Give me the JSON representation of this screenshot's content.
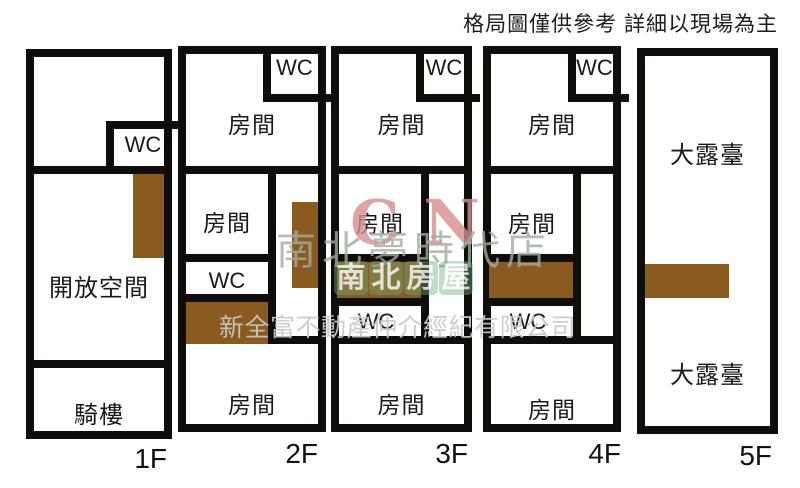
{
  "disclaimer": "格局圖僅供參考 詳細以現場為主",
  "watermark": {
    "initials": "CN",
    "store_line": "南北夢時代店",
    "brand_line": "南北房屋",
    "company_line": "新全富不動產仲介經紀有限公司"
  },
  "colors": {
    "wall": "#0f0d0a",
    "stair_fill": "#8b5a1f",
    "background": "#ffffff",
    "watermark_initials": "#d88f8f",
    "watermark_store": "#9fae9f",
    "watermark_brand": "#6faf78",
    "watermark_company": "#c9c9c9"
  },
  "floors": [
    {
      "label": "1F",
      "wc": "WC",
      "open_space": "開放空間",
      "arcade": "騎樓"
    },
    {
      "label": "2F",
      "wc_top": "WC",
      "room_top": "房間",
      "room_mid": "房間",
      "wc_mid": "WC",
      "room_bottom": "房間"
    },
    {
      "label": "3F",
      "wc_top": "WC",
      "room_top": "房間",
      "room_mid": "房間",
      "wc_mid": "WC",
      "room_bottom": "房間"
    },
    {
      "label": "4F",
      "wc_top": "WC",
      "room_top": "房間",
      "room_mid": "房間",
      "wc_mid": "WC",
      "room_bottom": "房間"
    },
    {
      "label": "5F",
      "terrace_top": "大露臺",
      "terrace_bottom": "大露臺"
    }
  ]
}
